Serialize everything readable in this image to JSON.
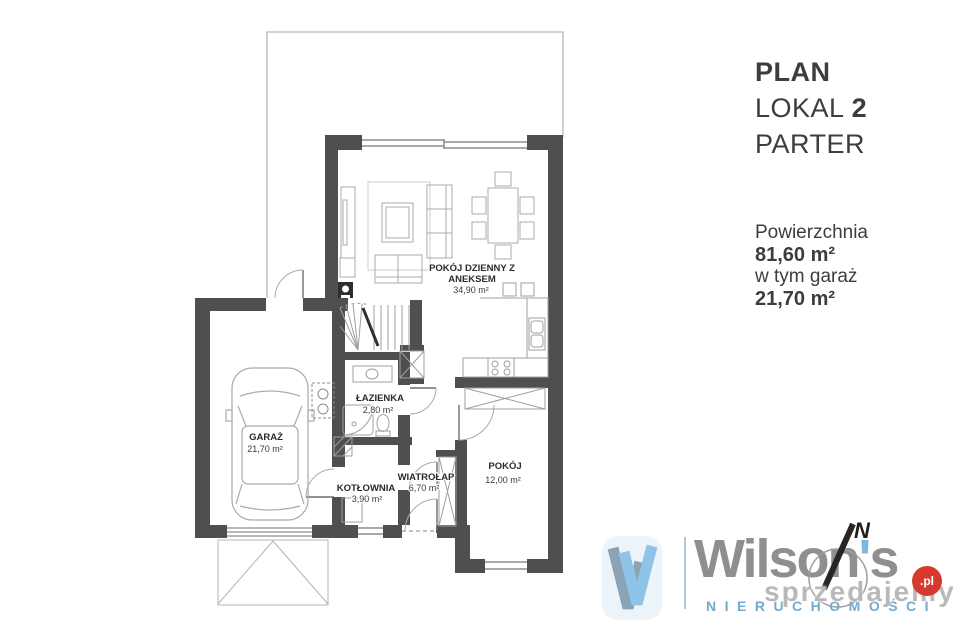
{
  "panel": {
    "title_line1": "PLAN",
    "title_line2a": "LOKAL",
    "title_line2b": "2",
    "title_line3": "PARTER",
    "area_label": "Powierzchnia",
    "area_value": "81,60 m²",
    "area_sublabel": "w tym garaż",
    "area_subvalue": "21,70 m²"
  },
  "rooms": {
    "living": {
      "name_line1": "POKÓJ DZIENNY Z",
      "name_line2": "ANEKSEM",
      "area": "34,90 m²"
    },
    "garage": {
      "name": "GARAŻ",
      "area": "21,70 m²"
    },
    "bathroom": {
      "name": "ŁAZIENKA",
      "area": "2,80 m²"
    },
    "boiler_room": {
      "name": "KOTŁOWNIA",
      "area": "3,90 m²"
    },
    "vestibule": {
      "name": "WIATROŁAP",
      "area": "6,70 m²"
    },
    "room": {
      "name": "POKÓJ",
      "area": "12,00 m²"
    }
  },
  "branding": {
    "name": "Wilson",
    "apostrophe": "'",
    "name_suffix": "s",
    "subtitle": "NIERUCHOMOŚCI",
    "watermark": "sprzedajemy",
    "watermark_badge": ".pl"
  },
  "compass": {
    "north_label": "N"
  },
  "colors": {
    "wall": "#4f4f4f",
    "thin_line": "#9aa0a6",
    "text": "#3d3d3d",
    "brand_gray": "#8f8f8f",
    "brand_blue": "#76a9c8",
    "logo_blue": "#8fc3e8",
    "badge_red": "#d6392e"
  }
}
